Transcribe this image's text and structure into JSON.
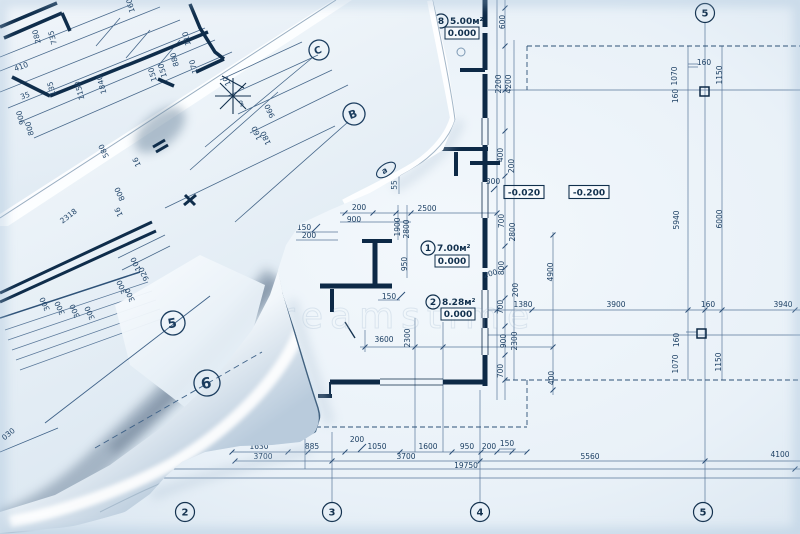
{
  "watermark": "dreamstime",
  "palette": {
    "paper": "#eef4f9",
    "line": "#3f6288",
    "wall": "#0d2946",
    "text": "#1c3f63",
    "dash": "#2d5176",
    "roll_shadow": "#6a8097",
    "roll_highlight": "#ffffff"
  },
  "plan": {
    "grid_bubbles": [
      {
        "t": "5",
        "x": 705,
        "y": 13
      },
      {
        "t": "2",
        "x": 185,
        "y": 512
      },
      {
        "t": "3",
        "x": 332,
        "y": 512
      },
      {
        "t": "4",
        "x": 480,
        "y": 512
      },
      {
        "t": "5",
        "x": 703,
        "y": 512
      }
    ],
    "rooms": [
      {
        "num": "8",
        "area": "5.00м²",
        "level": "0.000",
        "cx": 441,
        "cy": 21,
        "ax": 450,
        "ay": 24,
        "bx": 462,
        "by": 33
      },
      {
        "num": "1",
        "area": "7.00м²",
        "level": "0.000",
        "cx": 428,
        "cy": 248,
        "ax": 437,
        "ay": 251,
        "bx": 452,
        "by": 261
      },
      {
        "num": "2",
        "area": "8.28м²",
        "level": "0.000",
        "cx": 433,
        "cy": 302,
        "ax": 442,
        "ay": 305,
        "bx": 458,
        "by": 314
      }
    ],
    "elevation_boxes": [
      {
        "t": "-0.020",
        "x": 524,
        "y": 192
      },
      {
        "t": "-0.200",
        "x": 589,
        "y": 192
      }
    ],
    "texts": [
      {
        "t": "600",
        "x": 505,
        "y": 22,
        "r": -90
      },
      {
        "t": "2200",
        "x": 501,
        "y": 84,
        "r": -90
      },
      {
        "t": "4200",
        "x": 511,
        "y": 84,
        "r": -90
      },
      {
        "t": "400",
        "x": 503,
        "y": 155,
        "r": -90
      },
      {
        "t": "200",
        "x": 514,
        "y": 166,
        "r": -90
      },
      {
        "t": "300",
        "x": 493,
        "y": 184,
        "r": 0
      },
      {
        "t": "700",
        "x": 504,
        "y": 221,
        "r": -90
      },
      {
        "t": "2800",
        "x": 515,
        "y": 232,
        "r": -90
      },
      {
        "t": "800",
        "x": 504,
        "y": 268,
        "r": -90
      },
      {
        "t": "200",
        "x": 491,
        "y": 276,
        "r": -15
      },
      {
        "t": "200",
        "x": 518,
        "y": 290,
        "r": -90
      },
      {
        "t": "700",
        "x": 503,
        "y": 307,
        "r": -90
      },
      {
        "t": "1380",
        "x": 523,
        "y": 307,
        "r": 0
      },
      {
        "t": "900",
        "x": 506,
        "y": 341,
        "r": -90
      },
      {
        "t": "2300",
        "x": 517,
        "y": 341,
        "r": -90
      },
      {
        "t": "700",
        "x": 503,
        "y": 371,
        "r": -90
      },
      {
        "t": "400",
        "x": 554,
        "y": 378,
        "r": -90
      },
      {
        "t": "4900",
        "x": 553,
        "y": 272,
        "r": -90
      },
      {
        "t": "3900",
        "x": 616,
        "y": 307,
        "r": 0
      },
      {
        "t": "160",
        "x": 708,
        "y": 307,
        "r": 0
      },
      {
        "t": "3940",
        "x": 783,
        "y": 307,
        "r": 0
      },
      {
        "t": "5940",
        "x": 679,
        "y": 220,
        "r": -90
      },
      {
        "t": "6000",
        "x": 722,
        "y": 219,
        "r": -90
      },
      {
        "t": "1070",
        "x": 677,
        "y": 76,
        "r": -90
      },
      {
        "t": "160",
        "x": 704,
        "y": 65,
        "r": 0
      },
      {
        "t": "1150",
        "x": 722,
        "y": 75,
        "r": -90
      },
      {
        "t": "160",
        "x": 678,
        "y": 96,
        "r": -90
      },
      {
        "t": "160",
        "x": 679,
        "y": 340,
        "r": -90
      },
      {
        "t": "1070",
        "x": 678,
        "y": 364,
        "r": -90
      },
      {
        "t": "1150",
        "x": 721,
        "y": 362,
        "r": -90
      },
      {
        "t": "2500",
        "x": 427,
        "y": 211,
        "r": 0
      },
      {
        "t": "200",
        "x": 359,
        "y": 210,
        "r": 0
      },
      {
        "t": "900",
        "x": 354,
        "y": 222,
        "r": 0
      },
      {
        "t": "150",
        "x": 304,
        "y": 230,
        "r": 0
      },
      {
        "t": "200",
        "x": 309,
        "y": 238,
        "r": 0
      },
      {
        "t": "1900",
        "x": 400,
        "y": 227,
        "r": -90
      },
      {
        "t": "2800",
        "x": 409,
        "y": 229,
        "r": -90
      },
      {
        "t": "950",
        "x": 407,
        "y": 264,
        "r": -90
      },
      {
        "t": "150",
        "x": 389,
        "y": 299,
        "r": 0
      },
      {
        "t": "55",
        "x": 397,
        "y": 185,
        "r": -90
      },
      {
        "t": "3600",
        "x": 384,
        "y": 342,
        "r": 0
      },
      {
        "t": "2300",
        "x": 410,
        "y": 338,
        "r": -90
      },
      {
        "t": "1630",
        "x": 259,
        "y": 449,
        "r": 0
      },
      {
        "t": "885",
        "x": 312,
        "y": 449,
        "r": 0
      },
      {
        "t": "200",
        "x": 357,
        "y": 442,
        "r": 0
      },
      {
        "t": "1050",
        "x": 377,
        "y": 449,
        "r": 0
      },
      {
        "t": "1600",
        "x": 428,
        "y": 449,
        "r": 0
      },
      {
        "t": "950",
        "x": 467,
        "y": 449,
        "r": 0
      },
      {
        "t": "200",
        "x": 489,
        "y": 449,
        "r": 0
      },
      {
        "t": "150",
        "x": 507,
        "y": 446,
        "r": 0
      },
      {
        "t": "3700",
        "x": 263,
        "y": 459,
        "r": 0
      },
      {
        "t": "3700",
        "x": 406,
        "y": 459,
        "r": 0
      },
      {
        "t": "5560",
        "x": 590,
        "y": 459,
        "r": 0
      },
      {
        "t": "4100",
        "x": 780,
        "y": 457,
        "r": 0
      },
      {
        "t": "19750",
        "x": 466,
        "y": 468,
        "r": 0
      }
    ]
  },
  "rolls": {
    "bubbles": [
      {
        "t": "C",
        "x": 319,
        "y": 50,
        "r": 10,
        "fs": 10,
        "tilt": -20
      },
      {
        "t": "B",
        "x": 354,
        "y": 114,
        "r": 11,
        "fs": 11,
        "tilt": -20
      },
      {
        "t": "5",
        "x": 173,
        "y": 323,
        "r": 12,
        "fs": 13,
        "tilt": -10
      },
      {
        "t": "6",
        "x": 207,
        "y": 383,
        "r": 13,
        "fs": 15,
        "tilt": -10
      },
      {
        "t": "a",
        "x": 386,
        "y": 170,
        "r": 8,
        "fs": 8,
        "tilt": -35,
        "ellipse": true
      }
    ],
    "texts": [
      {
        "t": "280",
        "x": 39,
        "y": 36,
        "r": -105
      },
      {
        "t": "735",
        "x": 55,
        "y": 37,
        "r": -105
      },
      {
        "t": "410",
        "x": 22,
        "y": 69,
        "r": -20
      },
      {
        "t": "135",
        "x": 54,
        "y": 88,
        "r": -105
      },
      {
        "t": "35",
        "x": 26,
        "y": 98,
        "r": -20
      },
      {
        "t": "1150",
        "x": 82,
        "y": 90,
        "r": -105
      },
      {
        "t": "1840",
        "x": 104,
        "y": 84,
        "r": -105
      },
      {
        "t": "150",
        "x": 155,
        "y": 74,
        "r": -105
      },
      {
        "t": "150",
        "x": 165,
        "y": 70,
        "r": -105
      },
      {
        "t": "880",
        "x": 177,
        "y": 59,
        "r": -105
      },
      {
        "t": "110",
        "x": 189,
        "y": 38,
        "r": -105
      },
      {
        "t": "170",
        "x": 196,
        "y": 66,
        "r": -105
      },
      {
        "t": "900",
        "x": 23,
        "y": 117,
        "r": -105
      },
      {
        "t": "800",
        "x": 32,
        "y": 128,
        "r": -105
      },
      {
        "t": "160",
        "x": 133,
        "y": 5,
        "r": -105
      },
      {
        "t": "960",
        "x": 272,
        "y": 110,
        "r": -115
      },
      {
        "t": "160",
        "x": 259,
        "y": 132,
        "r": -115
      },
      {
        "t": "180",
        "x": 268,
        "y": 137,
        "r": -115
      },
      {
        "t": "10",
        "x": 229,
        "y": 80,
        "r": -115
      },
      {
        "t": "3",
        "x": 242,
        "y": 106,
        "r": -15,
        "fs": 9
      },
      {
        "t": "2318",
        "x": 70,
        "y": 218,
        "r": -38,
        "fs": 13
      },
      {
        "t": "580",
        "x": 106,
        "y": 150,
        "r": -115
      },
      {
        "t": "16",
        "x": 139,
        "y": 161,
        "r": -115
      },
      {
        "t": "800",
        "x": 122,
        "y": 193,
        "r": -115
      },
      {
        "t": "16",
        "x": 121,
        "y": 211,
        "r": -115
      },
      {
        "t": "100",
        "x": 138,
        "y": 263,
        "r": -115
      },
      {
        "t": "920",
        "x": 146,
        "y": 273,
        "r": -115
      },
      {
        "t": "300",
        "x": 124,
        "y": 286,
        "r": -115
      },
      {
        "t": "300",
        "x": 132,
        "y": 294,
        "r": -115
      },
      {
        "t": "300",
        "x": 47,
        "y": 303,
        "r": -115
      },
      {
        "t": "300",
        "x": 62,
        "y": 307,
        "r": -115
      },
      {
        "t": "300",
        "x": 77,
        "y": 310,
        "r": -115
      },
      {
        "t": "300",
        "x": 92,
        "y": 312,
        "r": -115
      },
      {
        "t": "030",
        "x": 10,
        "y": 436,
        "r": -40
      }
    ]
  }
}
